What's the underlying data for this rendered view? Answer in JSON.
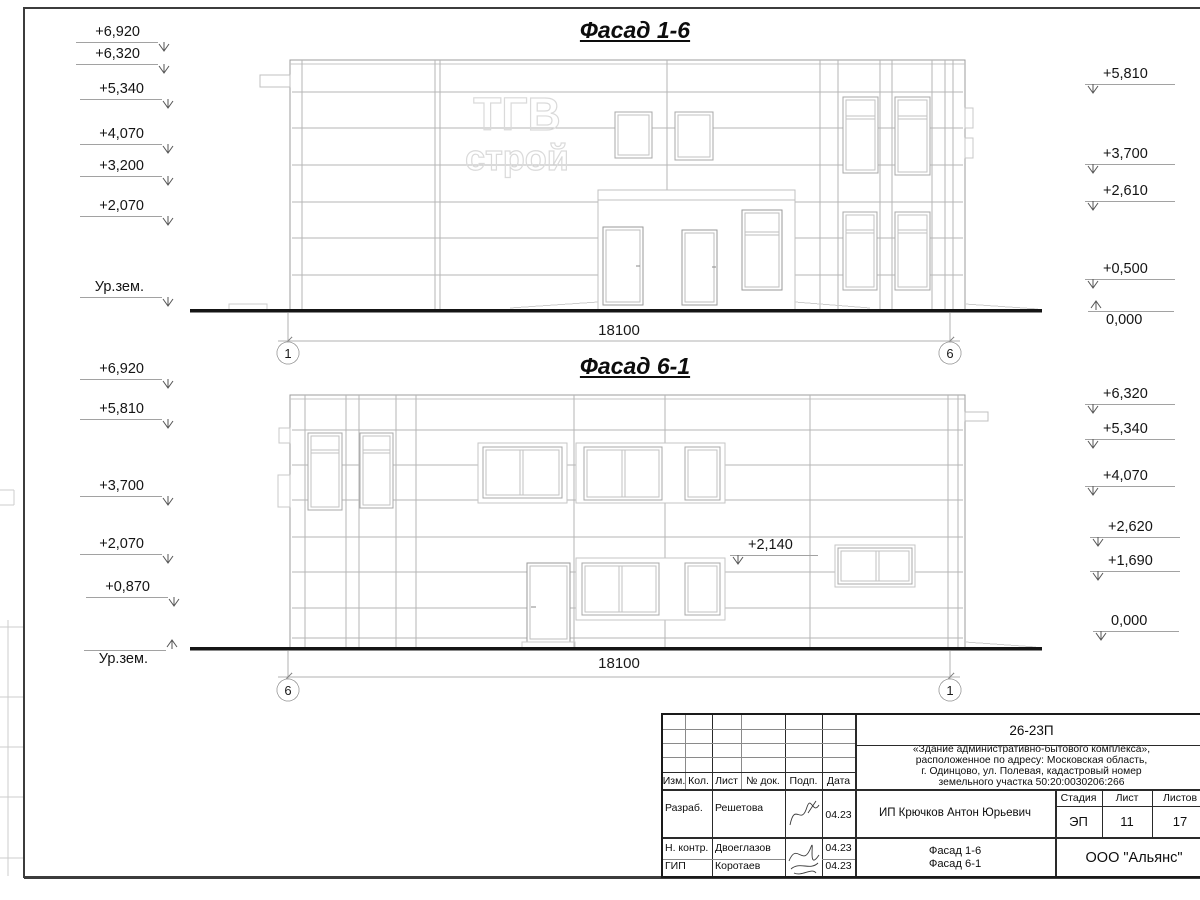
{
  "facade_top": {
    "title": "Фасад 1-6",
    "logo": {
      "line1": "ТГВ",
      "line2": "строй"
    },
    "left_marks": [
      "+6,920",
      "+6,320",
      "+5,340",
      "+4,070",
      "+3,200",
      "+2,070",
      "Ур.зем."
    ],
    "right_marks": [
      "+5,810",
      "+3,700",
      "+2,610",
      "+0,500",
      "0,000"
    ],
    "dimension": "18100",
    "axis_left": "1",
    "axis_right": "6"
  },
  "facade_bottom": {
    "title": "Фасад 6-1",
    "left_marks": [
      "+6,920",
      "+5,810",
      "+3,700",
      "+2,070",
      "+0,870",
      "Ур.зем."
    ],
    "right_marks": [
      "+6,320",
      "+5,340",
      "+4,070",
      "+2,620",
      "+1,690",
      "0,000"
    ],
    "inner_mark": "+2,140",
    "dimension": "18100",
    "axis_left": "6",
    "axis_right": "1"
  },
  "title_block": {
    "doc_number": "26-23П",
    "project_desc_lines": [
      "«Здание административно-бытового комплекса»,",
      "расположенное по адресу: Московская область,",
      "г. Одинцово, ул. Полевая, кадастровый номер",
      "земельного участка 50:20:0030206:266"
    ],
    "header_cols": {
      "izm": "Изм.",
      "kol": "Кол.",
      "list": "Лист",
      "doc": "№ док.",
      "podp": "Подп.",
      "data": "Дата"
    },
    "rows": [
      {
        "role": "Разраб.",
        "name": "Решетова",
        "date": "04.23"
      },
      {
        "role": "Н. контр.",
        "name": "Двоеглазов",
        "date": "04.23"
      },
      {
        "role": "ГИП",
        "name": "Коротаев",
        "date": "04.23"
      }
    ],
    "client": "ИП Крючков Антон Юрьевич",
    "stage_label": "Стадия",
    "sheet_label": "Лист",
    "sheets_label": "Листов",
    "stage": "ЭП",
    "sheet_num": "11",
    "sheets_total": "17",
    "sheet_title_line1": "Фасад 1-6",
    "sheet_title_line2": "Фасад 6-1",
    "company": "ООО \"Альянс\""
  }
}
